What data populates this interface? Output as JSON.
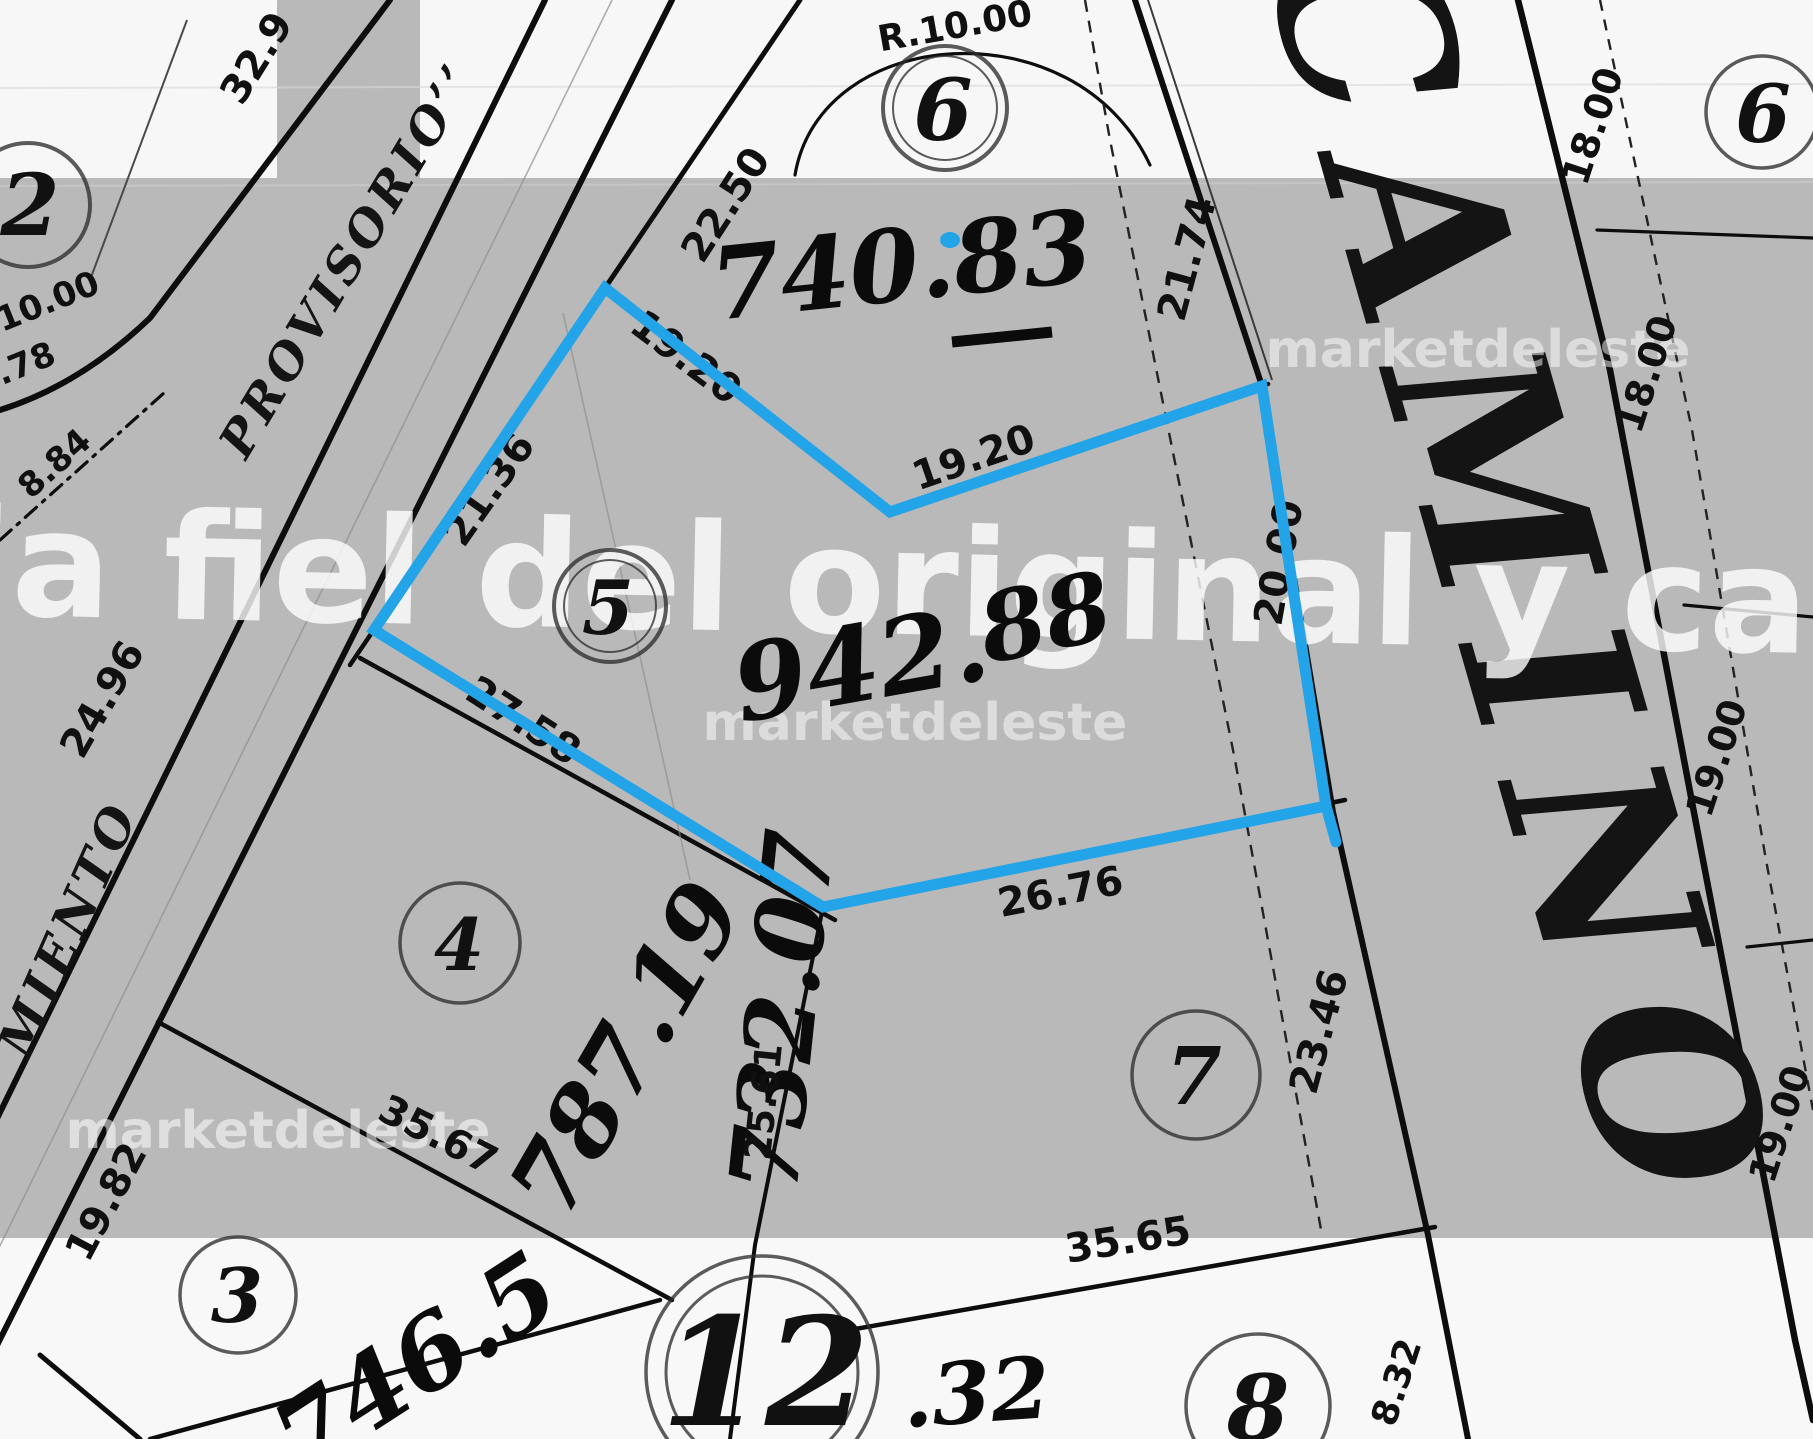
{
  "map": {
    "highlight_color": "#23a3e8",
    "roads": {
      "camino": "CAMINO",
      "provisorio": "PROVISORIO’’",
      "miento": "MIENTO"
    },
    "lots": {
      "lot2": "2",
      "lot3": "3",
      "lot4": "4",
      "lot5": "5",
      "lot6_top": "6",
      "lot6_right": "6",
      "lot7": "7",
      "lot8": "8",
      "lot12": "12"
    },
    "areas": {
      "lot6_top": "740.83",
      "lot5_main": "942.",
      "lot5_frac": "88",
      "lot4": "787.19",
      "lot12": "732.07",
      "lot3": "746.5",
      "bottom_partial": ".32"
    },
    "measurements": {
      "m32_9": "32.9",
      "m22_50": "22.50",
      "mr10": "R.10.00",
      "m21_74": "21.74",
      "m18_a": "18.00",
      "m18_b": "18.00",
      "m19_a": "19.00",
      "m19_b": "19.00",
      "m10_00": "10.00",
      "m78": ".78",
      "m8_84": "8.84",
      "m21_36": "21.36",
      "m19_20a": "19.20",
      "m19_20b": "19.20",
      "m20_00": "20.00",
      "m24_96": "24.96",
      "m27_58": "27.58",
      "m26_76": "26.76",
      "m23_46": "23.46",
      "m35_67": "35.67",
      "m25_61": "25.61",
      "m19_82": "19.82",
      "m35_65": "35.65",
      "m8_32": "8.32"
    }
  },
  "watermarks": {
    "big": "ia fiel del original y car",
    "small": "marketdeleste"
  }
}
